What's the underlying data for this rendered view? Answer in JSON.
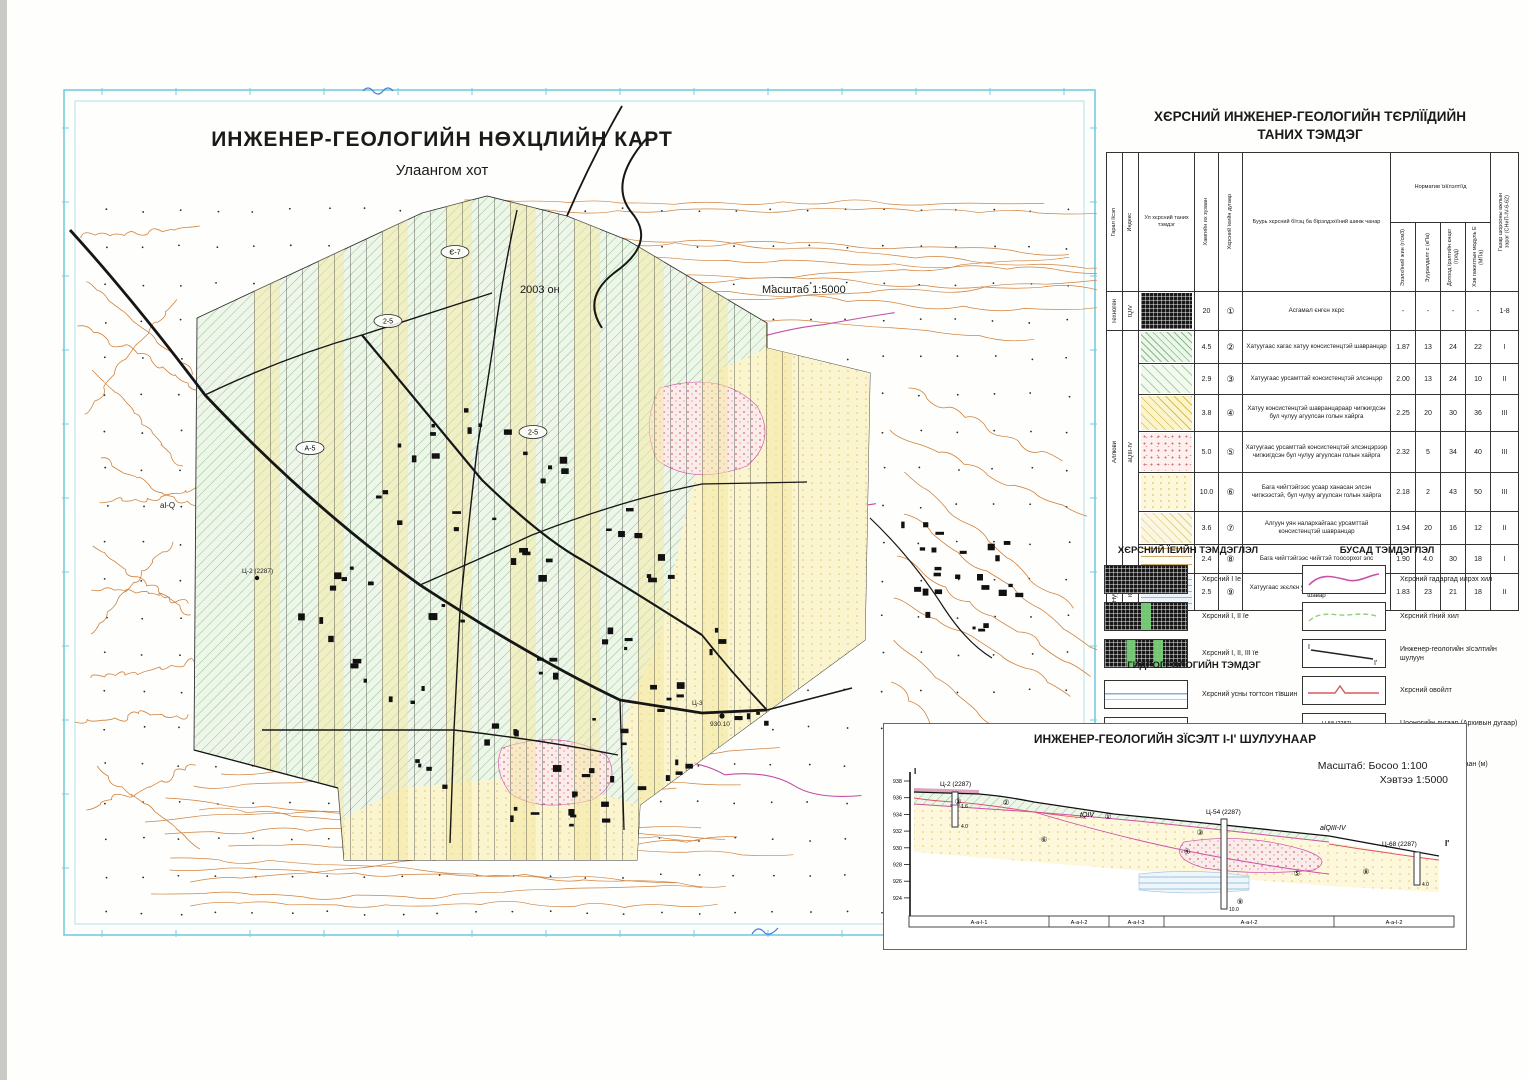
{
  "map": {
    "title": "ИНЖЕНЕР-ГЕОЛОГИЙН НӨХЦЛИЙН КАРТ",
    "subtitle": "Улаангом хот",
    "year_label": "2003 он",
    "scale_label": "Масштаб 1:5000",
    "label_alq": "al-Q",
    "label_bh1": "Ц-2 (2287)",
    "label_bh2": "Ц-3",
    "label_bh2_elev": "930.10",
    "ellipses": [
      "2-5",
      "А-5",
      "2-5",
      "Є-7"
    ]
  },
  "legend_table": {
    "title_line1": "ХЄРСНИЙ ИНЖЕНЕР-ГЕОЛОГИЙН ТЄРЛЇЇДИЙН",
    "title_line2": "ТАНИХ ТЭМДЭГ",
    "col_origin": "Гарал їїсэл",
    "col_index": "Индекс",
    "col_symbol": "Ул хєрсний таних тэмдэг",
    "col_thickness": "Хамгийн их зузаан",
    "col_layer_no": "Хєрсний їеийн дугаар",
    "col_description": "Буурь хєрсний бїтэц ба бїрэлдэхїїний шинж чанар",
    "col_norm_group": "Норматив їзїїлэлтїїд",
    "col_density": "Эзэлхїїний жин (г/см3)",
    "col_cohesion": "Зууралдалт с (кПа)",
    "col_friction": "Дотоод їрэлтийн єнцєг (град)",
    "col_modulus": "Хэв гажилтын модуль Е (МПа)",
    "col_category": "Газар шорооны ажлын зэрэг (СНиП-IV-6-62)",
    "groups": [
      {
        "origin": "Техноген",
        "index": "tQIV"
      },
      {
        "origin": "Аллюви",
        "index": "aQIII-IV"
      },
      {
        "origin": "Нуурын",
        "index": "lQIII"
      }
    ],
    "rows": [
      {
        "thickness": "20",
        "num": "①",
        "desc": "Асгамал єнгєн хєрс",
        "density": "-",
        "cohesion": "-",
        "friction": "-",
        "modulus": "-",
        "category": "1-8"
      },
      {
        "thickness": "4.5",
        "num": "②",
        "desc": "Хатуугаас хагас хатуу консистенцтэй шавранцар",
        "density": "1.87",
        "cohesion": "13",
        "friction": "24",
        "modulus": "22",
        "category": "I"
      },
      {
        "thickness": "2.9",
        "num": "③",
        "desc": "Хатуугаас урсамттай консистенцтэй элсэнцэр",
        "density": "2.00",
        "cohesion": "13",
        "friction": "24",
        "modulus": "10",
        "category": "II"
      },
      {
        "thickness": "3.8",
        "num": "④",
        "desc": "Хатуу консистенцтэй шавранцараар чигжигдсэн бул чулуу агуулсан голын хайрга",
        "density": "2.25",
        "cohesion": "20",
        "friction": "30",
        "modulus": "36",
        "category": "III"
      },
      {
        "thickness": "5.0",
        "num": "⑤",
        "desc": "Хатуугаас урсамттай консистенцтэй элсэнцэрээр чигжигдсэн бул чулуу агуулсан голын хайрга",
        "density": "2.32",
        "cohesion": "5",
        "friction": "34",
        "modulus": "40",
        "category": "III"
      },
      {
        "thickness": "10.0",
        "num": "⑥",
        "desc": "Бага чийгтэйгээс усаар ханасан элсэн чигжээстэй, бул чулуу агуулсан голын хайрга",
        "density": "2.18",
        "cohesion": "2",
        "friction": "43",
        "modulus": "50",
        "category": "III"
      },
      {
        "thickness": "3.6",
        "num": "⑦",
        "desc": "Алгуун уян налархайгаас урсамттай консистенцтэй шавранцар",
        "density": "1.94",
        "cohesion": "20",
        "friction": "16",
        "modulus": "12",
        "category": "II"
      },
      {
        "thickness": "2.4",
        "num": "⑧",
        "desc": "Бага чийгтэйгээс чийгтэй тоосорхог элс",
        "density": "1.90",
        "cohesion": "4.0",
        "friction": "30",
        "modulus": "18",
        "category": "I"
      },
      {
        "thickness": "2.5",
        "num": "⑨",
        "desc": "Хатуугаас зєєлєн уян налархай консистенцтэй шавар",
        "density": "1.83",
        "cohesion": "23",
        "friction": "21",
        "modulus": "18",
        "category": "II"
      }
    ]
  },
  "layer_legend": {
    "title": "ХЄРСНИЙ ЇЕИЙН ТЭМДЭГЛЭЛ",
    "items": [
      "Хєрсний I їе",
      "Хєрсний I, II їе",
      "Хєрсний I, II, III їе"
    ]
  },
  "hydro_legend": {
    "title": "ГИДРОГЕОЛОГИЙН ТЭМДЭГ",
    "items": [
      "Хєрсний усны тогтсон тївшин",
      "Намагжсан талбай"
    ]
  },
  "other_legend": {
    "title": "БУСАД ТЭМДЭГЛЭЛ",
    "item1": "Хєрсний гадаргад илрэх хил",
    "item2": "Хєрсний гїний хил",
    "item3": "Инженер-геологийн зїсэлтийн шулуун",
    "item4": "Хєрсний овойлт",
    "item5a": "Цооногийн дугаар (Архивын дугаар)",
    "item5b": "Їнэмлэхїй єндєр (м)",
    "item6": "Хєрсний їеїдийн зузаан (м)",
    "borehole_example_no": "Ц-58 (2287)",
    "borehole_example_elev": "930.10",
    "thickness_example": "2-5",
    "mark_i": "I",
    "mark_i2": "I'"
  },
  "section": {
    "title": "ИНЖЕНЕР-ГЕОЛОГИЙН ЗЇСЭЛТ I-I' ШУЛУУНААР",
    "scale_prefix": "Масштаб:",
    "scale_v": "Босоо  1:100",
    "scale_h": "Хэвтээ 1:5000",
    "elevations": [
      "938",
      "936",
      "934",
      "932",
      "930",
      "928",
      "926",
      "924"
    ],
    "boreholes": [
      {
        "name": "Ц-2 (2287)",
        "d1": "1.6",
        "d2": "4.0"
      },
      {
        "name": "Ц-54 (2287)",
        "d1": "10.0"
      },
      {
        "name": "Ц-68 (2287)",
        "d1": "4.0"
      }
    ],
    "unit_tq": "tQIV",
    "unit_alq": "alQIII-IV",
    "mark_left": "I",
    "mark_right": "I'",
    "circles": {
      "n1": "①",
      "n2": "②",
      "n3": "③",
      "n4": "④",
      "n5": "⑤",
      "n6": "⑥",
      "n8": "⑧",
      "n9": "⑨"
    },
    "segments": [
      "А-а-I-1",
      "А-а-I-2",
      "А-а-I-3",
      "А-а-I-2",
      "А-а-I-2"
    ]
  }
}
